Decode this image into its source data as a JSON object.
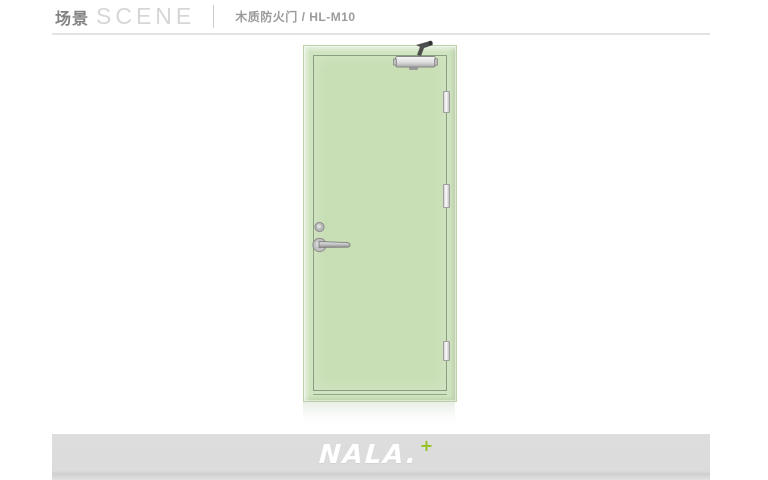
{
  "header": {
    "section_title_cn": "场景",
    "section_title_en": "SCENE",
    "product_label": "木质防火门 / HL-M10"
  },
  "product_image": {
    "description_parts": [
      "door-closer",
      "cylinder-lock",
      "lever-handle",
      "hinge-top",
      "hinge-middle",
      "hinge-bottom"
    ],
    "door_fill_color": "#cfe4c0",
    "door_trim_line_color": "#8d9e80"
  },
  "footer": {
    "brand_name": "NALA.",
    "brand_plus": "+",
    "accent_color": "#95c11f",
    "band_color": "#dcdcdc"
  }
}
